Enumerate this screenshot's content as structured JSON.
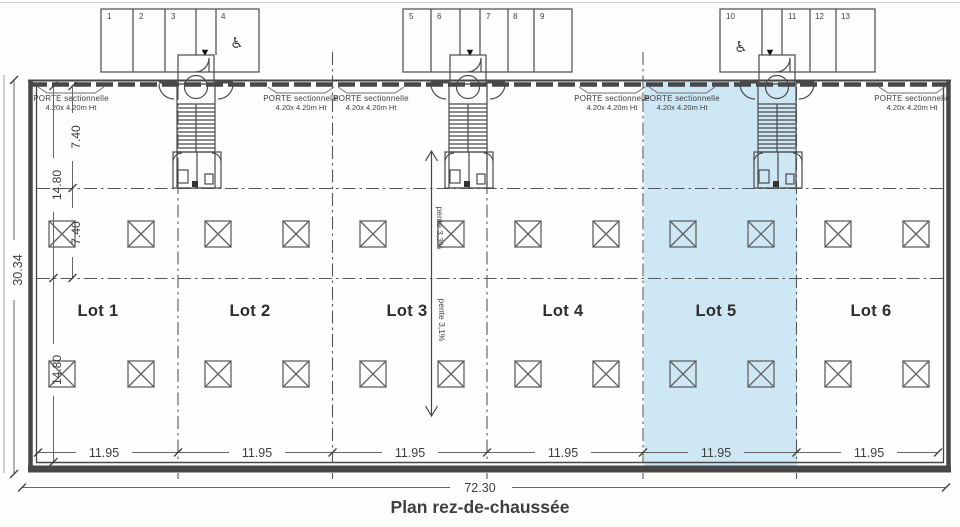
{
  "title": "Plan rez-de-chaussée",
  "colors": {
    "highlight": "#cde7f4",
    "ink": "#3f3f3f",
    "title_ink": "#2f4f6b"
  },
  "lots": [
    {
      "label": "Lot 1",
      "width": "11.95"
    },
    {
      "label": "Lot 2",
      "width": "11.95"
    },
    {
      "label": "Lot 3",
      "width": "11.95"
    },
    {
      "label": "Lot 4",
      "width": "11.95"
    },
    {
      "label": "Lot 5",
      "width": "11.95"
    },
    {
      "label": "Lot 6",
      "width": "11.95"
    }
  ],
  "dimensions": {
    "total_width": "72.30",
    "total_height": "30.34",
    "front_bay_depth": "7.40",
    "half_depth": "14.80"
  },
  "door_label": {
    "line1": "PORTE sectionnelle",
    "line2": "4.20x 4.20m Ht"
  },
  "slopes": {
    "upper": "pente 3,3%",
    "lower": "pente 3,1%"
  },
  "parking": {
    "spaces": [
      "1",
      "2",
      "3",
      "4",
      "5",
      "6",
      "7",
      "8",
      "9",
      "10",
      "11",
      "12",
      "13"
    ]
  },
  "icons": {
    "wheelchair": "♿",
    "entrance_arrow": "▼"
  }
}
